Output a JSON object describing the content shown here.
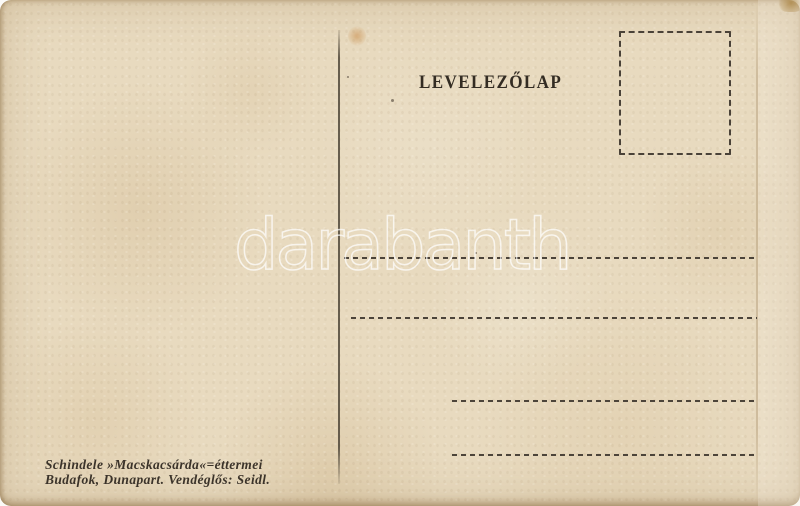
{
  "postcard": {
    "title": "LEVELEZŐLAP",
    "watermark_text": "darabanth",
    "publisher": {
      "line1": "Schindele »Macskacsárda«=éttermei",
      "line2": "Budafok, Dunapart. Vendéglős: Seidl."
    },
    "colors": {
      "paper": "#e8dabf",
      "ink": "#332c23",
      "rule_dashes": "#4c443a",
      "watermark_outline": "#ffffff"
    }
  }
}
